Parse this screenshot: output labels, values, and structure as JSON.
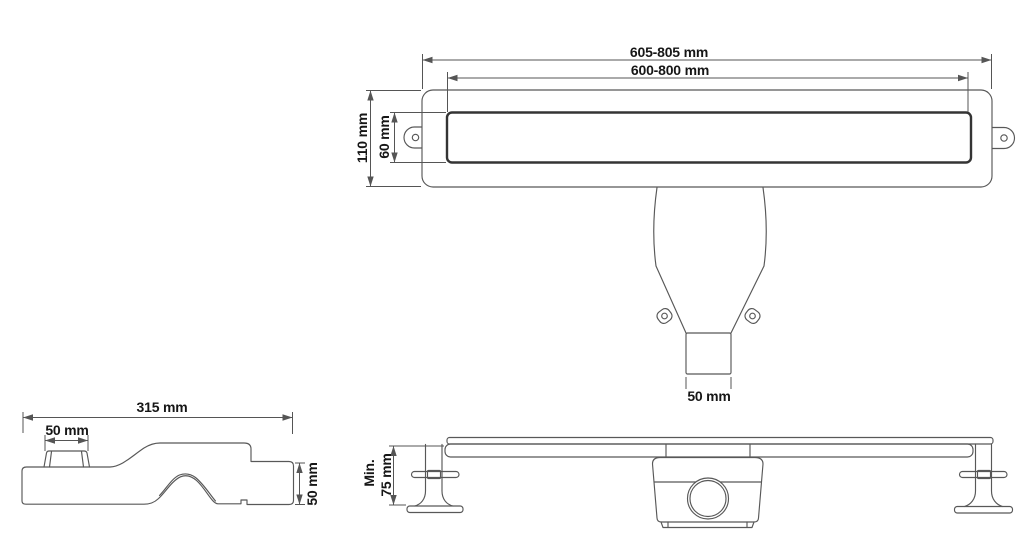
{
  "drawing_title": "linear shower drain technical drawing",
  "colors": {
    "background": "#ffffff",
    "line": "#585858",
    "grate_line": "#343434",
    "text": "#161616"
  },
  "top_view": {
    "outer_width": "605-805 mm",
    "inner_width": "600-800 mm",
    "outer_height": "110 mm",
    "grate_height": "60 mm",
    "outlet_width": "50 mm"
  },
  "side_view": {
    "length": "315 mm",
    "inlet_width": "50 mm",
    "outlet_height": "50 mm"
  },
  "front_view": {
    "min_label": "Min.",
    "min_height": "75 mm"
  }
}
